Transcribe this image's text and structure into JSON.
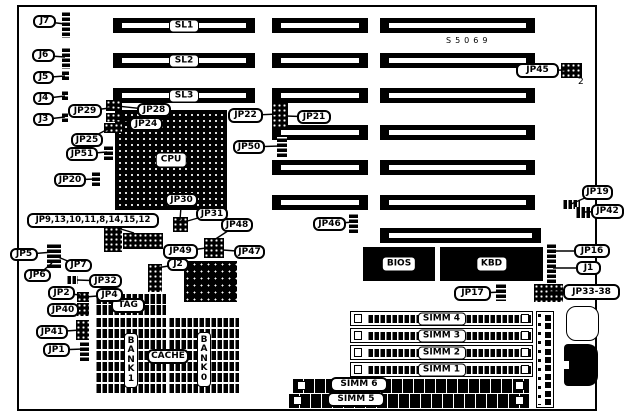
{
  "board": {
    "x": 17,
    "y": 5,
    "w": 580,
    "h": 406
  },
  "slots": {
    "labeled": [
      {
        "label": "SL1",
        "x": 113,
        "y": 18,
        "w": 142,
        "h": 15
      },
      {
        "label": "SL2",
        "x": 113,
        "y": 53,
        "w": 142,
        "h": 15
      },
      {
        "label": "SL3",
        "x": 113,
        "y": 88,
        "w": 142,
        "h": 15
      }
    ],
    "plain": [
      {
        "x": 272,
        "y": 18,
        "w": 96,
        "h": 15
      },
      {
        "x": 272,
        "y": 53,
        "w": 96,
        "h": 15
      },
      {
        "x": 272,
        "y": 88,
        "w": 96,
        "h": 15
      },
      {
        "x": 272,
        "y": 125,
        "w": 96,
        "h": 15
      },
      {
        "x": 272,
        "y": 160,
        "w": 96,
        "h": 15
      },
      {
        "x": 272,
        "y": 195,
        "w": 96,
        "h": 15
      },
      {
        "x": 380,
        "y": 18,
        "w": 155,
        "h": 15
      },
      {
        "x": 380,
        "y": 53,
        "w": 155,
        "h": 15
      },
      {
        "x": 380,
        "y": 88,
        "w": 155,
        "h": 15
      },
      {
        "x": 380,
        "y": 125,
        "w": 155,
        "h": 15
      },
      {
        "x": 380,
        "y": 160,
        "w": 155,
        "h": 15
      },
      {
        "x": 380,
        "y": 195,
        "w": 155,
        "h": 15
      },
      {
        "x": 380,
        "y": 228,
        "w": 161,
        "h": 15
      }
    ]
  },
  "chips": {
    "cpu": {
      "label": "CPU",
      "x": 115,
      "y": 110,
      "w": 112,
      "h": 100
    },
    "chipset": {
      "x": 184,
      "y": 261,
      "w": 53,
      "h": 41
    },
    "bios": {
      "label": "BIOS",
      "x": 363,
      "y": 247,
      "w": 72,
      "h": 34
    },
    "kbd": {
      "label": "KBD",
      "x": 440,
      "y": 247,
      "w": 103,
      "h": 34
    }
  },
  "cache": {
    "tag_label": "TAG",
    "cache_label": "CACHE",
    "bank1_label": "BANK1",
    "bank0_label": "BANK0",
    "tag_box": {
      "x": 111,
      "y": 298,
      "w": 34,
      "h": 15
    },
    "cache_box": {
      "x": 147,
      "y": 349,
      "w": 42,
      "h": 15
    },
    "bank1_box": {
      "x": 124,
      "y": 333,
      "w": 14,
      "h": 55
    },
    "bank0_box": {
      "x": 197,
      "y": 332,
      "w": 14,
      "h": 55
    },
    "tag_rows": [
      {
        "x": 95,
        "y": 294,
        "w": 71,
        "h": 10
      },
      {
        "x": 95,
        "y": 305,
        "w": 71,
        "h": 10
      }
    ],
    "left_rows": [
      {
        "x": 95,
        "y": 318,
        "w": 71,
        "h": 9
      },
      {
        "x": 95,
        "y": 329,
        "w": 71,
        "h": 9
      },
      {
        "x": 95,
        "y": 340,
        "w": 71,
        "h": 9
      },
      {
        "x": 95,
        "y": 351,
        "w": 71,
        "h": 9
      },
      {
        "x": 95,
        "y": 362,
        "w": 71,
        "h": 9
      },
      {
        "x": 95,
        "y": 373,
        "w": 71,
        "h": 9
      },
      {
        "x": 95,
        "y": 384,
        "w": 71,
        "h": 9
      }
    ],
    "right_rows": [
      {
        "x": 168,
        "y": 318,
        "w": 71,
        "h": 9
      },
      {
        "x": 168,
        "y": 329,
        "w": 71,
        "h": 9
      },
      {
        "x": 168,
        "y": 340,
        "w": 71,
        "h": 9
      },
      {
        "x": 168,
        "y": 351,
        "w": 71,
        "h": 9
      },
      {
        "x": 168,
        "y": 362,
        "w": 71,
        "h": 9
      },
      {
        "x": 168,
        "y": 373,
        "w": 71,
        "h": 9
      },
      {
        "x": 168,
        "y": 384,
        "w": 71,
        "h": 9
      }
    ]
  },
  "simms": {
    "horizontal": [
      {
        "label": "SIMM 4",
        "x": 350,
        "y": 311,
        "w": 183,
        "h": 15
      },
      {
        "label": "SIMM 3",
        "x": 350,
        "y": 328,
        "w": 183,
        "h": 15
      },
      {
        "label": "SIMM 2",
        "x": 350,
        "y": 345,
        "w": 183,
        "h": 15
      },
      {
        "label": "SIMM 1",
        "x": 350,
        "y": 362,
        "w": 183,
        "h": 15
      }
    ],
    "long": [
      {
        "label": "SIMM 6",
        "x": 292,
        "y": 379,
        "w": 237,
        "h": 14,
        "label_box": {
          "x": 330,
          "y": 377,
          "w": 58,
          "h": 15
        }
      },
      {
        "label": "SIMM 5",
        "x": 288,
        "y": 394,
        "w": 241,
        "h": 14,
        "label_box": {
          "x": 327,
          "y": 392,
          "w": 58,
          "h": 15
        }
      }
    ]
  },
  "connectors": {
    "power": {
      "x": 536,
      "y": 311,
      "w": 18,
      "h": 97,
      "pins": 11
    },
    "kb_outline": {
      "x": 566,
      "y": 306,
      "w": 33,
      "h": 35
    },
    "kb_din": {
      "x": 564,
      "y": 344,
      "w": 34,
      "h": 42
    }
  },
  "jumpers": [
    {
      "id": "j7-header",
      "x": 62,
      "y": 11,
      "w": 8,
      "h": 27,
      "style": "v"
    },
    {
      "id": "j6-header",
      "x": 62,
      "y": 47,
      "w": 8,
      "h": 22,
      "style": "v"
    },
    {
      "id": "j5-header",
      "x": 62,
      "y": 70,
      "w": 7,
      "h": 11,
      "style": "v"
    },
    {
      "id": "j4-header",
      "x": 62,
      "y": 90,
      "w": 6,
      "h": 11,
      "style": "v"
    },
    {
      "id": "j3-header",
      "x": 62,
      "y": 112,
      "w": 6,
      "h": 11,
      "style": "v"
    },
    {
      "id": "jp28-block",
      "x": 106,
      "y": 100,
      "w": 16,
      "h": 11,
      "style": "grid"
    },
    {
      "id": "jp29-block",
      "x": 106,
      "y": 113,
      "w": 16,
      "h": 9,
      "style": "grid"
    },
    {
      "id": "jp24-block",
      "x": 104,
      "y": 123,
      "w": 18,
      "h": 10,
      "style": "grid"
    },
    {
      "id": "jp51-block",
      "x": 104,
      "y": 145,
      "w": 9,
      "h": 16,
      "style": "v"
    },
    {
      "id": "jp20-block",
      "x": 92,
      "y": 171,
      "w": 8,
      "h": 16,
      "style": "v"
    },
    {
      "id": "jp8-15-block-a",
      "x": 104,
      "y": 227,
      "w": 18,
      "h": 25,
      "style": "grid"
    },
    {
      "id": "jp8-15-block-b",
      "x": 123,
      "y": 233,
      "w": 40,
      "h": 16,
      "style": "grid"
    },
    {
      "id": "jp5-7-header",
      "x": 47,
      "y": 243,
      "w": 14,
      "h": 25,
      "style": "v"
    },
    {
      "id": "jp32-block",
      "x": 66,
      "y": 276,
      "w": 12,
      "h": 8,
      "style": "h"
    },
    {
      "id": "jp2-4-block",
      "x": 77,
      "y": 292,
      "w": 12,
      "h": 10,
      "style": "grid"
    },
    {
      "id": "jp40-block",
      "x": 77,
      "y": 303,
      "w": 12,
      "h": 13,
      "style": "grid"
    },
    {
      "id": "jp41-block",
      "x": 76,
      "y": 320,
      "w": 13,
      "h": 20,
      "style": "grid"
    },
    {
      "id": "jp1-block",
      "x": 80,
      "y": 341,
      "w": 9,
      "h": 20,
      "style": "v"
    },
    {
      "id": "jp30-31-block",
      "x": 173,
      "y": 217,
      "w": 15,
      "h": 15,
      "style": "grid"
    },
    {
      "id": "jp21-22-block",
      "x": 272,
      "y": 103,
      "w": 16,
      "h": 25,
      "style": "grid"
    },
    {
      "id": "jp50-block",
      "x": 277,
      "y": 137,
      "w": 10,
      "h": 21,
      "style": "v"
    },
    {
      "id": "jp47-49-block",
      "x": 204,
      "y": 238,
      "w": 20,
      "h": 20,
      "style": "grid"
    },
    {
      "id": "j2-block",
      "x": 148,
      "y": 264,
      "w": 14,
      "h": 28,
      "style": "grid"
    },
    {
      "id": "jp46-block",
      "x": 349,
      "y": 213,
      "w": 9,
      "h": 20,
      "style": "v"
    },
    {
      "id": "jp45-block",
      "x": 561,
      "y": 63,
      "w": 21,
      "h": 15,
      "style": "grid"
    },
    {
      "id": "jp19-block",
      "x": 562,
      "y": 200,
      "w": 18,
      "h": 9,
      "style": "h"
    },
    {
      "id": "jp42-block",
      "x": 575,
      "y": 207,
      "w": 16,
      "h": 11,
      "style": "h"
    },
    {
      "id": "jp16-j1-header",
      "x": 547,
      "y": 243,
      "w": 9,
      "h": 40,
      "style": "v"
    },
    {
      "id": "jp17-block",
      "x": 496,
      "y": 283,
      "w": 10,
      "h": 18,
      "style": "v"
    },
    {
      "id": "jp33-38-block",
      "x": 534,
      "y": 284,
      "w": 29,
      "h": 18,
      "style": "grid"
    }
  ],
  "callouts": [
    {
      "id": "j7",
      "label": "J7",
      "x": 33,
      "y": 15,
      "w": 23,
      "h": 13,
      "tx": 65,
      "ty": 24
    },
    {
      "id": "j6",
      "label": "J6",
      "x": 32,
      "y": 49,
      "w": 23,
      "h": 13,
      "tx": 65,
      "ty": 57
    },
    {
      "id": "j5",
      "label": "J5",
      "x": 33,
      "y": 71,
      "w": 21,
      "h": 13,
      "tx": 65,
      "ty": 76
    },
    {
      "id": "j4",
      "label": "J4",
      "x": 33,
      "y": 92,
      "w": 21,
      "h": 13,
      "tx": 65,
      "ty": 96
    },
    {
      "id": "j3",
      "label": "J3",
      "x": 33,
      "y": 113,
      "w": 21,
      "h": 13,
      "tx": 65,
      "ty": 117
    },
    {
      "id": "jp29",
      "label": "JP29",
      "x": 68,
      "y": 104,
      "w": 34,
      "h": 14,
      "tx": 110,
      "ty": 108
    },
    {
      "id": "jp28",
      "label": "JP28",
      "x": 137,
      "y": 103,
      "w": 34,
      "h": 14,
      "tx": 117,
      "ty": 106
    },
    {
      "id": "jp24",
      "label": "JP24",
      "x": 129,
      "y": 117,
      "w": 34,
      "h": 14,
      "tx": 116,
      "ty": 119
    },
    {
      "id": "jp25",
      "label": "JP25",
      "x": 71,
      "y": 133,
      "w": 32,
      "h": 14,
      "tx": 110,
      "ty": 128
    },
    {
      "id": "jp51",
      "label": "JP51",
      "x": 66,
      "y": 147,
      "w": 32,
      "h": 14,
      "tx": 107,
      "ty": 152
    },
    {
      "id": "jp20",
      "label": "JP20",
      "x": 54,
      "y": 173,
      "w": 32,
      "h": 14,
      "tx": 95,
      "ty": 179
    },
    {
      "id": "jp8-15-group",
      "label": "JP9,13,10,11,8,14,15,12",
      "x": 27,
      "y": 213,
      "w": 132,
      "h": 15,
      "fs": 8.5,
      "tx": 134,
      "ty": 233
    },
    {
      "id": "jp5",
      "label": "JP5",
      "x": 10,
      "y": 248,
      "w": 28,
      "h": 13,
      "tx": 53,
      "ty": 252
    },
    {
      "id": "jp7",
      "label": "JP7",
      "x": 65,
      "y": 259,
      "w": 27,
      "h": 13,
      "tx": 58,
      "ty": 257
    },
    {
      "id": "jp6",
      "label": "JP6",
      "x": 24,
      "y": 269,
      "w": 27,
      "h": 13,
      "tx": 52,
      "ty": 263
    },
    {
      "id": "jp32",
      "label": "JP32",
      "x": 89,
      "y": 274,
      "w": 33,
      "h": 14,
      "tx": 77,
      "ty": 280
    },
    {
      "id": "jp2",
      "label": "JP2",
      "x": 48,
      "y": 286,
      "w": 27,
      "h": 14,
      "tx": 80,
      "ty": 295
    },
    {
      "id": "jp4",
      "label": "JP4",
      "x": 96,
      "y": 288,
      "w": 27,
      "h": 14,
      "tx": 85,
      "ty": 297
    },
    {
      "id": "jp40",
      "label": "JP40",
      "x": 47,
      "y": 303,
      "w": 32,
      "h": 14,
      "tx": 81,
      "ty": 309
    },
    {
      "id": "jp41",
      "label": "JP41",
      "x": 36,
      "y": 325,
      "w": 32,
      "h": 14,
      "tx": 80,
      "ty": 330
    },
    {
      "id": "jp1",
      "label": "JP1",
      "x": 43,
      "y": 343,
      "w": 27,
      "h": 14,
      "tx": 83,
      "ty": 349
    },
    {
      "id": "jp30",
      "label": "JP30",
      "x": 165,
      "y": 193,
      "w": 33,
      "h": 14,
      "tx": 180,
      "ty": 220
    },
    {
      "id": "jp31",
      "label": "JP31",
      "x": 196,
      "y": 207,
      "w": 32,
      "h": 14,
      "tx": 184,
      "ty": 222
    },
    {
      "id": "jp22",
      "label": "JP22",
      "x": 228,
      "y": 108,
      "w": 35,
      "h": 15,
      "tx": 278,
      "ty": 114
    },
    {
      "id": "jp21",
      "label": "JP21",
      "x": 297,
      "y": 110,
      "w": 34,
      "h": 14,
      "tx": 286,
      "ty": 116
    },
    {
      "id": "jp50",
      "label": "JP50",
      "x": 233,
      "y": 140,
      "w": 32,
      "h": 14,
      "tx": 280,
      "ty": 146
    },
    {
      "id": "jp48",
      "label": "JP48",
      "x": 221,
      "y": 218,
      "w": 32,
      "h": 14,
      "tx": 214,
      "ty": 240
    },
    {
      "id": "jp49",
      "label": "JP49",
      "x": 163,
      "y": 244,
      "w": 35,
      "h": 15,
      "tx": 206,
      "ty": 248
    },
    {
      "id": "jp47",
      "label": "JP47",
      "x": 234,
      "y": 245,
      "w": 31,
      "h": 14,
      "tx": 223,
      "ty": 250
    },
    {
      "id": "j2",
      "label": "J2",
      "x": 167,
      "y": 258,
      "w": 22,
      "h": 13,
      "tx": 156,
      "ty": 268
    },
    {
      "id": "jp46",
      "label": "JP46",
      "x": 313,
      "y": 217,
      "w": 33,
      "h": 14,
      "tx": 353,
      "ty": 222
    },
    {
      "id": "jp45",
      "label": "JP45",
      "x": 516,
      "y": 63,
      "w": 43,
      "h": 15,
      "tx": 566,
      "ty": 70
    },
    {
      "id": "jp19",
      "label": "JP19",
      "x": 582,
      "y": 185,
      "w": 31,
      "h": 15,
      "tx": 571,
      "ty": 204
    },
    {
      "id": "jp42",
      "label": "JP42",
      "x": 591,
      "y": 204,
      "w": 33,
      "h": 15,
      "tx": 583,
      "ty": 212
    },
    {
      "id": "jp16",
      "label": "JP16",
      "x": 574,
      "y": 244,
      "w": 36,
      "h": 14,
      "tx": 553,
      "ty": 251
    },
    {
      "id": "j1",
      "label": "J1",
      "x": 576,
      "y": 261,
      "w": 25,
      "h": 14,
      "tx": 553,
      "ty": 268
    },
    {
      "id": "jp33-38",
      "label": "JP33-38",
      "x": 563,
      "y": 284,
      "w": 57,
      "h": 16,
      "tx": 550,
      "ty": 292
    },
    {
      "id": "jp17",
      "label": "JP17",
      "x": 454,
      "y": 286,
      "w": 37,
      "h": 15,
      "tx": 500,
      "ty": 292
    }
  ],
  "annotations": [
    {
      "id": "silkscreen",
      "text": "S5069",
      "x": 446,
      "y": 36,
      "spaced": true
    },
    {
      "id": "pin2-label",
      "text": "2",
      "x": 578,
      "y": 77
    }
  ]
}
